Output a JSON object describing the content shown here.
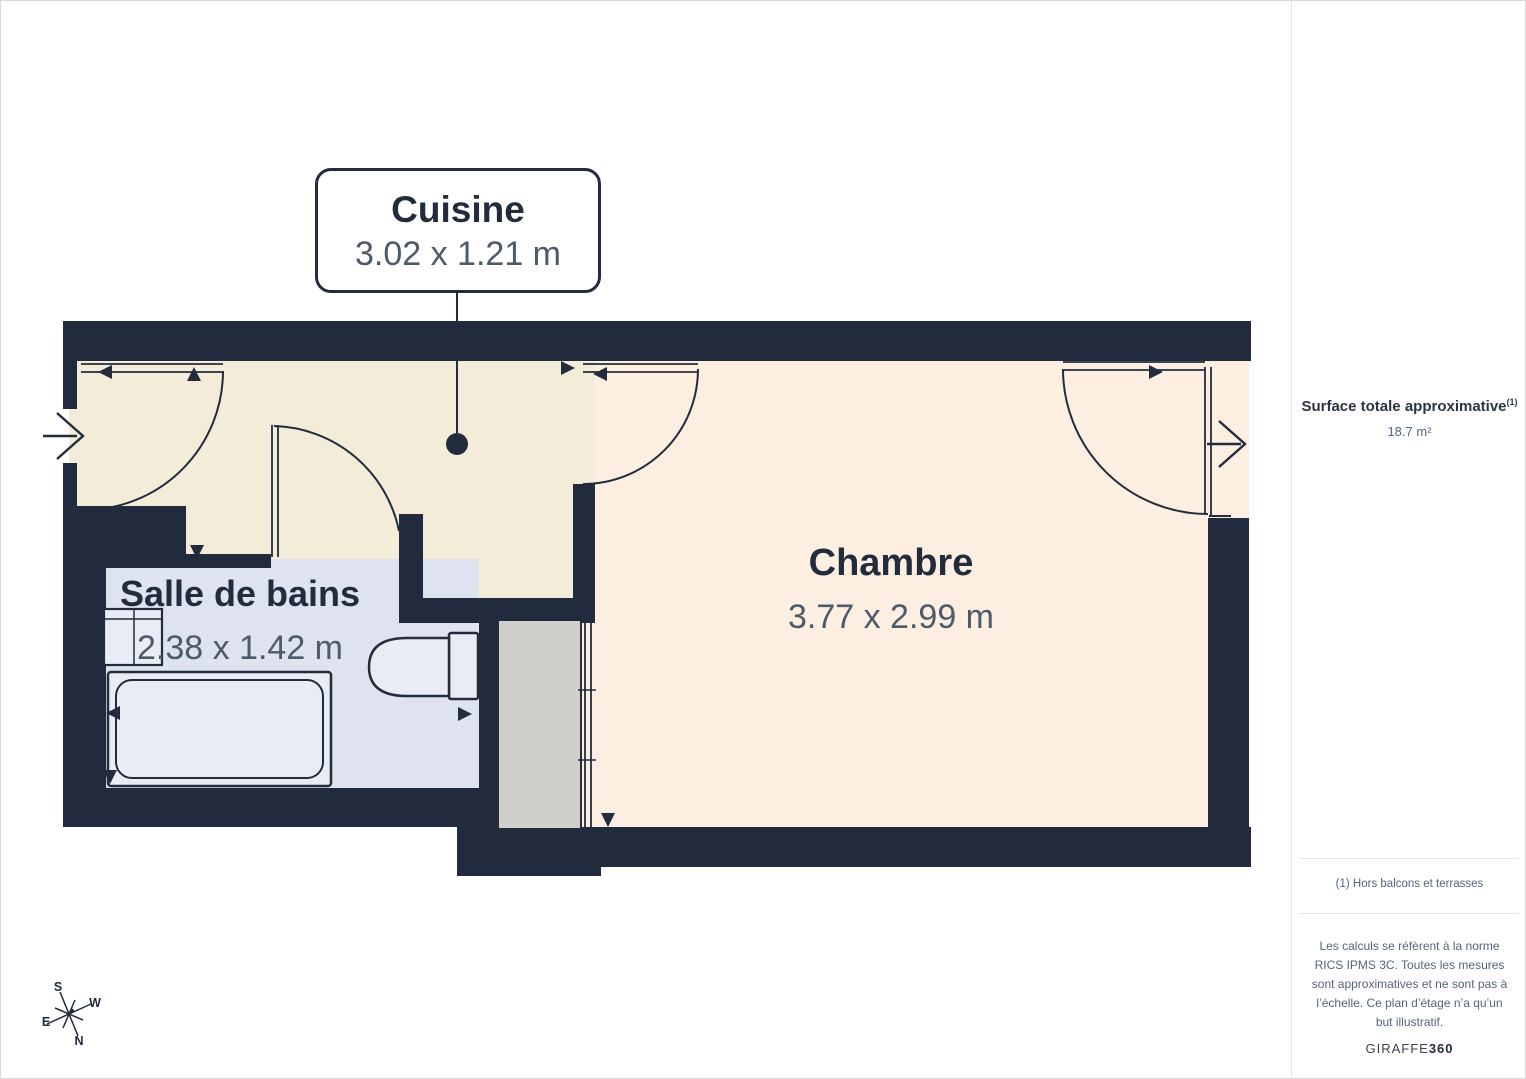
{
  "page": {
    "background": "#ffffff",
    "border_color": "#d9d9d9"
  },
  "plan": {
    "wall_color": "#212b3d",
    "line_color": "#222c3d",
    "floor_colors": {
      "cuisine": "#f3ecd8",
      "chambre": "#fdeee2",
      "bathroom": "#dfe3ef",
      "closet": "#d1cfcb"
    },
    "rooms": {
      "cuisine": {
        "name": "Cuisine",
        "dims": "3.02 x 1.21 m"
      },
      "chambre": {
        "name": "Chambre",
        "dims": "3.77 x 2.99 m"
      },
      "salle_de_bains": {
        "name": "Salle de bains",
        "dims": "2.38 x 1.42 m"
      }
    },
    "compass": {
      "north": "N",
      "south": "S",
      "east": "E",
      "west": "W"
    }
  },
  "sidebar": {
    "surface_title": "Surface totale approximative",
    "surface_sup": "(1)",
    "surface_value": "18.7 m²",
    "footnote": "(1) Hors balcons et terrasses",
    "disclaimer": "Les calculs se réfèrent à la norme RICS IPMS 3C. Toutes les mesures sont approximatives et ne sont pas à l’échelle. Ce plan d’étage n’a qu’un but illustratif.",
    "brand_name": "GIRAFFE",
    "brand_suffix": "360"
  }
}
